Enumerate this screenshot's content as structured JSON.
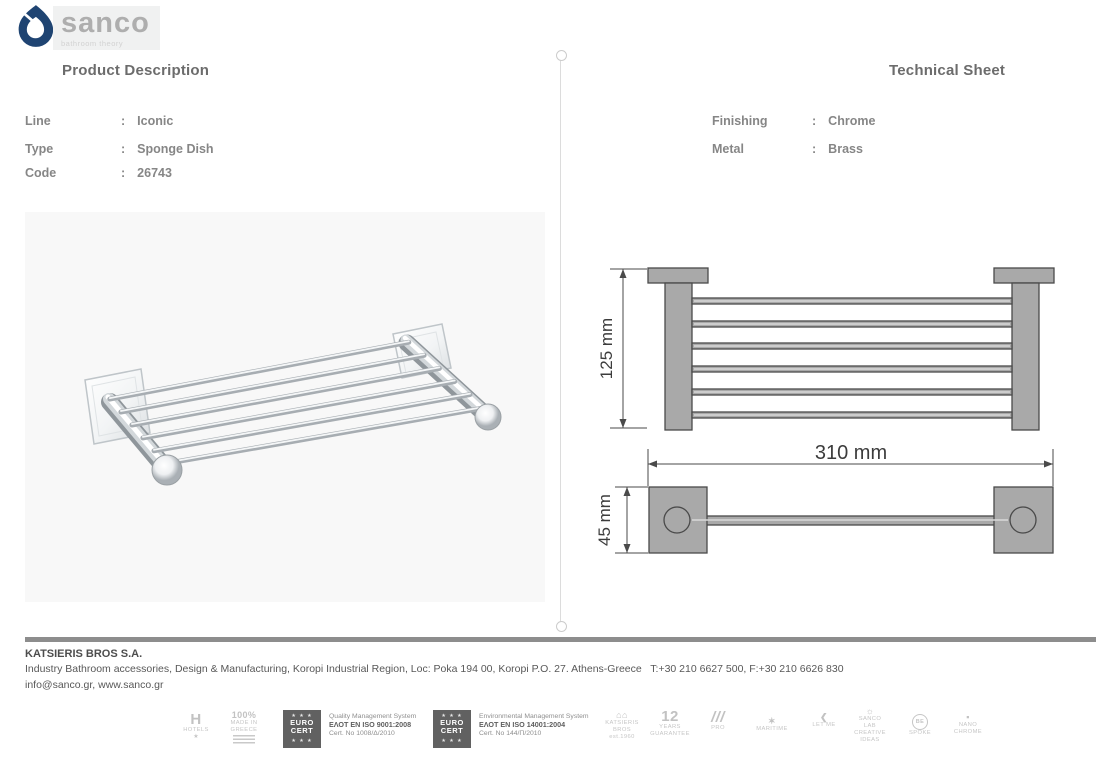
{
  "brand": {
    "name": "sanco",
    "tagline": "bathroom theory"
  },
  "product": {
    "title": "Product Description",
    "fields": [
      {
        "label": "Line",
        "sep": ":",
        "value": "Iconic"
      },
      {
        "label": "Type",
        "sep": ":",
        "value": "Sponge Dish"
      },
      {
        "label": "Code",
        "sep": ":",
        "value": "26743"
      }
    ]
  },
  "technical": {
    "title": "Technical Sheet",
    "fields": [
      {
        "label": "Finishing",
        "sep": ":",
        "value": "Chrome"
      },
      {
        "label": "Metal",
        "sep": ":",
        "value": "Brass"
      }
    ],
    "dimensions": {
      "height": "125 mm",
      "width": "310 mm",
      "depth": "45 mm"
    }
  },
  "footer": {
    "company": "KATSIERIS BROS S.A.",
    "address": "Industry Bathroom accessories, Design & Manufacturing, Koropi Industrial Region, Loc: Poka 194 00, Koropi P.O. 27. Athens-Greece   T:+30 210 6627 500, F:+30 210 6626 830",
    "contact": "info@sanco.gr, www.sanco.gr",
    "certs": [
      {
        "logo_top": "EURO",
        "logo_bottom": "CERT",
        "stars": "★ ★ ★",
        "line1": "Quality Management System",
        "line2": "ΕΛΟΤ EN ISO 9001:2008",
        "line3": "Cert. No 1008/Δ/2010"
      },
      {
        "logo_top": "EURO",
        "logo_bottom": "CERT",
        "stars": "★ ★ ★",
        "line1": "Environmental Management System",
        "line2": "ΕΛΟΤ EN ISO 14001:2004",
        "line3": "Cert. No 144/Π/2010"
      }
    ],
    "badges": {
      "hotels": {
        "icon": "H",
        "label": "HOTELS",
        "star": "★"
      },
      "greece": {
        "pct": "100%",
        "made": "MADE IN",
        "country": "GREECE"
      },
      "katsieris": {
        "icon": "⌂⌂",
        "l1": "KATSIERIS",
        "l2": "BROS",
        "l3": "est.1960"
      },
      "years": {
        "num": "12",
        "l1": "YEARS",
        "l2": "GUARANTEE"
      },
      "pro": {
        "icon": "///",
        "l1": "PRO"
      },
      "maritime": {
        "star": "✶",
        "l1": "MARITIME"
      },
      "letme": {
        "icon": "❮",
        "l1": "LET ME"
      },
      "sancolab": {
        "icon": "☼",
        "l1": "SANCO",
        "l2": "LAB",
        "l3": "CREATIVE",
        "l4": "IDEAS"
      },
      "bespoke": {
        "l1": "BE",
        "l2": "SPOKE"
      },
      "nano": {
        "icon": "▪",
        "l1": "NANO",
        "l2": "CHROME"
      }
    }
  }
}
